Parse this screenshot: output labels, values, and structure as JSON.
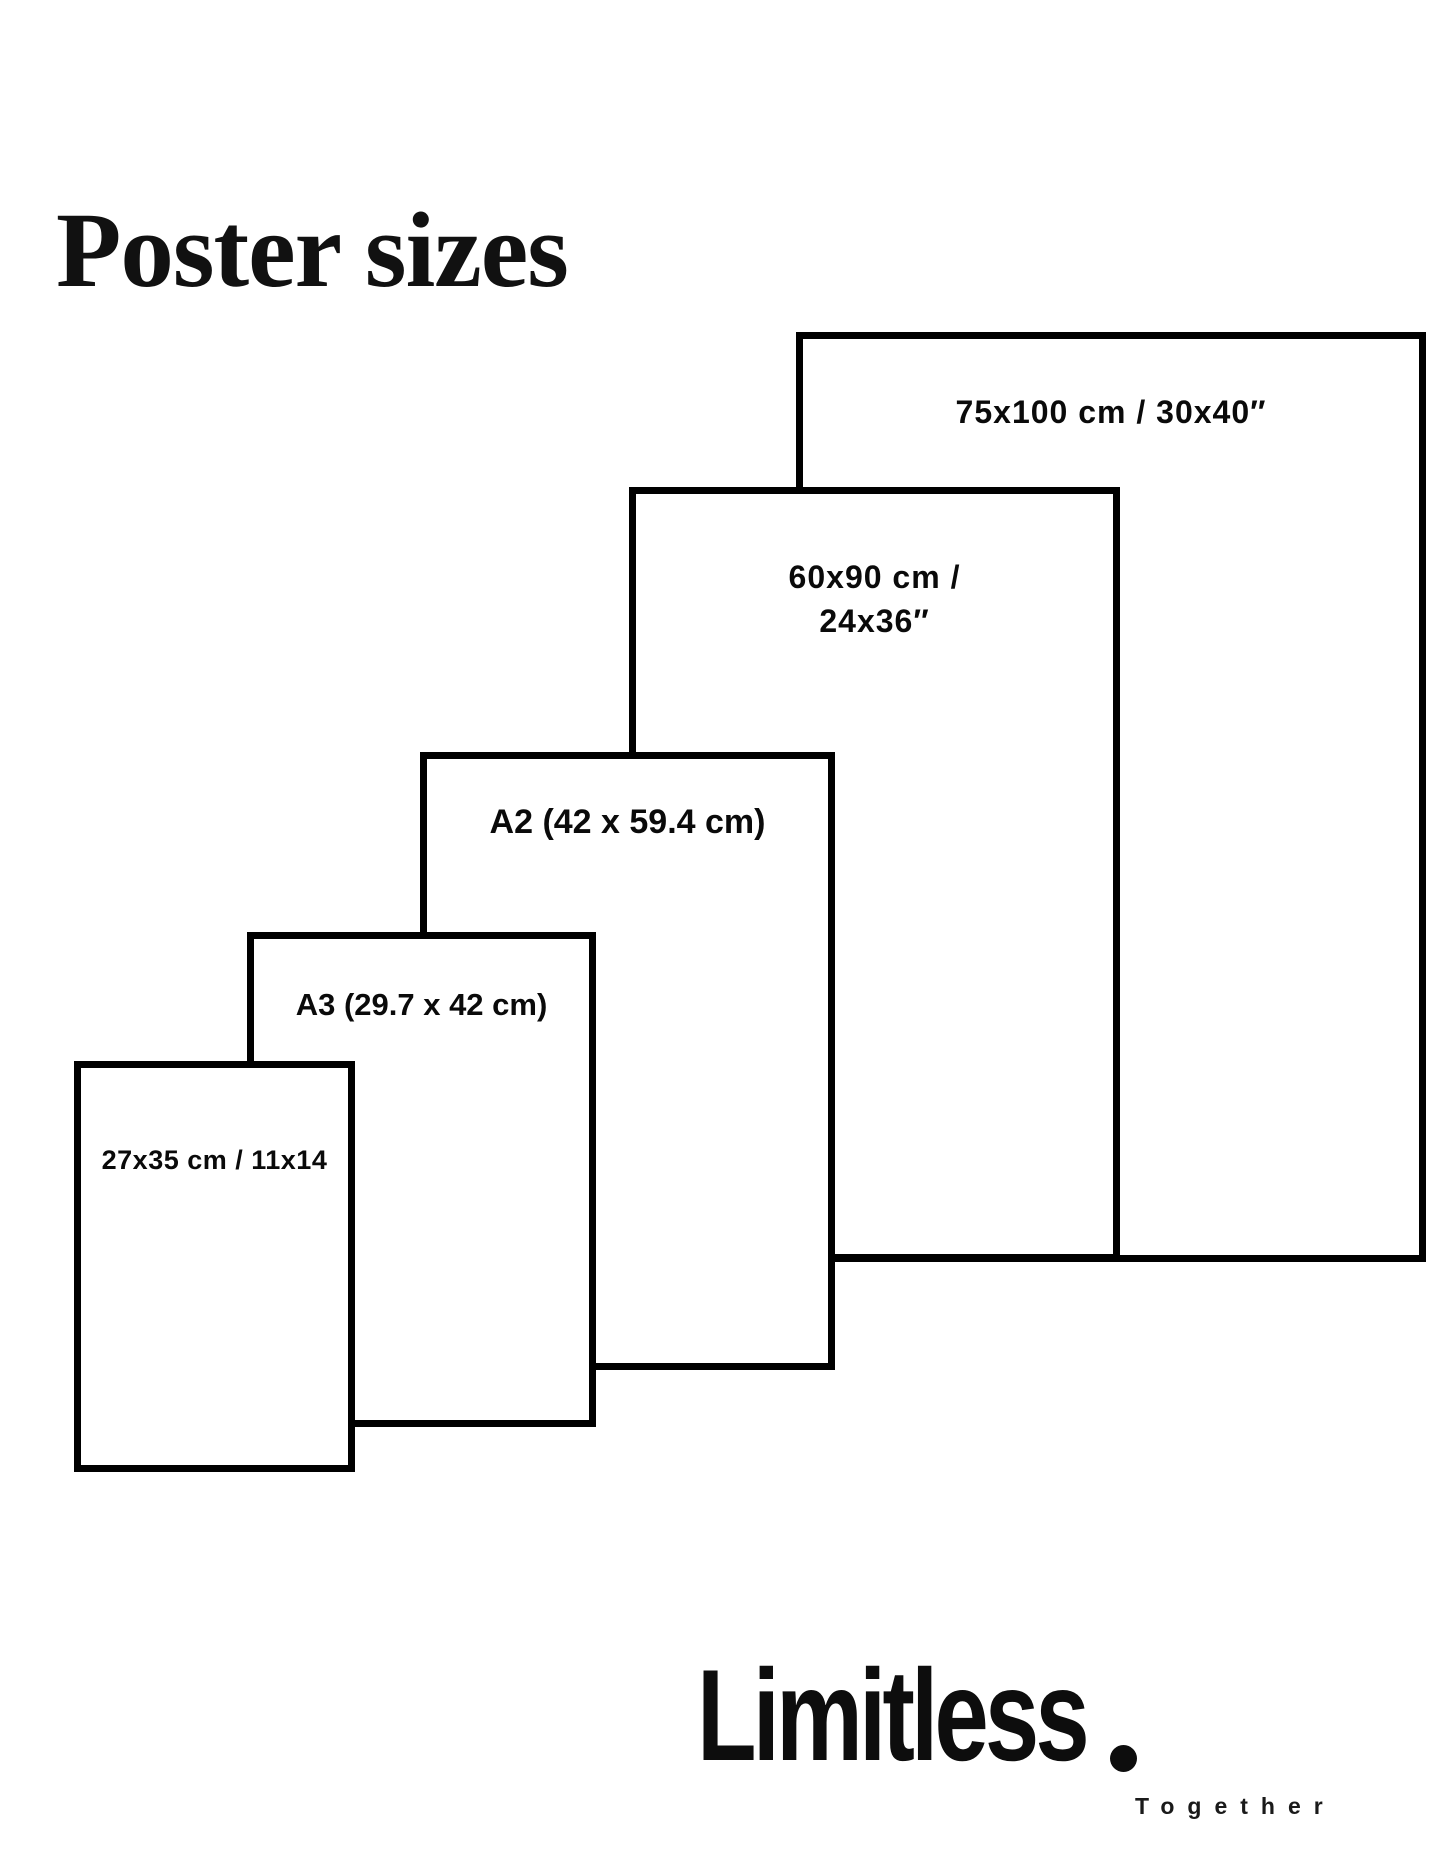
{
  "title": "Poster sizes",
  "diagram": {
    "sizes": [
      {
        "id": "75x100",
        "label": "75x100 cm / 30x40″"
      },
      {
        "id": "60x90",
        "label_line1": "60x90 cm /",
        "label_line2": "24x36″"
      },
      {
        "id": "a2",
        "label": "A2 (42 x 59.4 cm)"
      },
      {
        "id": "a3",
        "label": "A3 (29.7 x 42 cm)"
      },
      {
        "id": "27x35",
        "label": "27x35 cm / 11x14"
      }
    ]
  },
  "logo": {
    "brand": "Limitless",
    "tagline": "Together"
  },
  "colors": {
    "background": "#ffffff",
    "line": "#000000",
    "text": "#0a0a0a"
  }
}
